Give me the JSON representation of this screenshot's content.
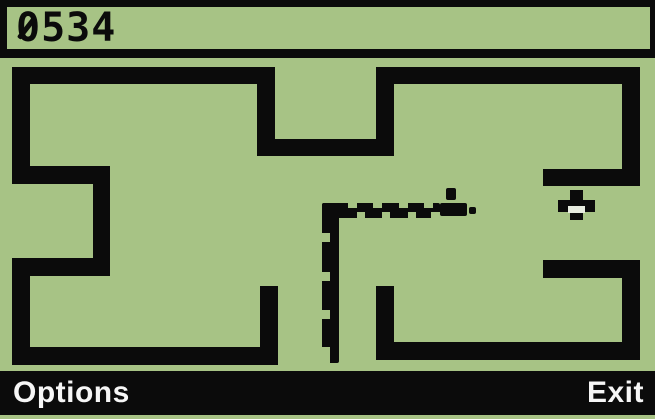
{
  "colors": {
    "bg_green": "#a7c385",
    "ink": "#0b0b0b",
    "softkey_text": "#f6f6f6",
    "food_notch": "#e8ede0"
  },
  "statusbar": {
    "score": "0534"
  },
  "softkeys": {
    "left": "Options",
    "right": "Exit"
  },
  "maze": {
    "walls": [
      {
        "x": 12,
        "y": 67,
        "w": 263,
        "h": 17
      },
      {
        "x": 12,
        "y": 67,
        "w": 18,
        "h": 117
      },
      {
        "x": 12,
        "y": 166,
        "w": 98,
        "h": 18
      },
      {
        "x": 93,
        "y": 166,
        "w": 17,
        "h": 110
      },
      {
        "x": 12,
        "y": 258,
        "w": 98,
        "h": 18
      },
      {
        "x": 12,
        "y": 258,
        "w": 18,
        "h": 107
      },
      {
        "x": 12,
        "y": 347,
        "w": 266,
        "h": 18
      },
      {
        "x": 260,
        "y": 286,
        "w": 18,
        "h": 79
      },
      {
        "x": 257,
        "y": 67,
        "w": 18,
        "h": 89
      },
      {
        "x": 257,
        "y": 139,
        "w": 136,
        "h": 17
      },
      {
        "x": 376,
        "y": 67,
        "w": 18,
        "h": 89
      },
      {
        "x": 376,
        "y": 67,
        "w": 264,
        "h": 17
      },
      {
        "x": 622,
        "y": 67,
        "w": 18,
        "h": 119
      },
      {
        "x": 543,
        "y": 169,
        "w": 97,
        "h": 17
      },
      {
        "x": 543,
        "y": 260,
        "w": 97,
        "h": 18
      },
      {
        "x": 622,
        "y": 260,
        "w": 18,
        "h": 100
      },
      {
        "x": 376,
        "y": 342,
        "w": 264,
        "h": 18
      },
      {
        "x": 376,
        "y": 286,
        "w": 18,
        "h": 74
      }
    ]
  },
  "snake": {
    "bars": [
      {
        "x": 322,
        "y": 203,
        "w": 118,
        "h": 15
      },
      {
        "x": 322,
        "y": 203,
        "w": 17,
        "h": 160
      }
    ],
    "head_parts": [
      {
        "x": 440,
        "y": 203,
        "w": 27,
        "h": 13
      },
      {
        "x": 446,
        "y": 188,
        "w": 10,
        "h": 12
      },
      {
        "x": 469,
        "y": 207,
        "w": 7,
        "h": 7
      }
    ],
    "notches": [
      {
        "x": 348,
        "y": 203,
        "w": 9,
        "h": 5
      },
      {
        "x": 373,
        "y": 203,
        "w": 9,
        "h": 5
      },
      {
        "x": 399,
        "y": 203,
        "w": 9,
        "h": 5
      },
      {
        "x": 424,
        "y": 203,
        "w": 9,
        "h": 5
      },
      {
        "x": 357,
        "y": 212,
        "w": 8,
        "h": 6
      },
      {
        "x": 382,
        "y": 212,
        "w": 8,
        "h": 6
      },
      {
        "x": 408,
        "y": 212,
        "w": 8,
        "h": 6
      },
      {
        "x": 431,
        "y": 212,
        "w": 9,
        "h": 6
      },
      {
        "x": 322,
        "y": 233,
        "w": 8,
        "h": 9
      },
      {
        "x": 322,
        "y": 272,
        "w": 8,
        "h": 9
      },
      {
        "x": 322,
        "y": 310,
        "w": 8,
        "h": 9
      },
      {
        "x": 322,
        "y": 347,
        "w": 8,
        "h": 16
      }
    ]
  },
  "food": {
    "parts": [
      {
        "x": 570,
        "y": 190,
        "w": 13,
        "h": 30
      },
      {
        "x": 558,
        "y": 200,
        "w": 37,
        "h": 12
      }
    ],
    "notches": [
      {
        "x": 568,
        "y": 206,
        "w": 17,
        "h": 7
      }
    ]
  }
}
